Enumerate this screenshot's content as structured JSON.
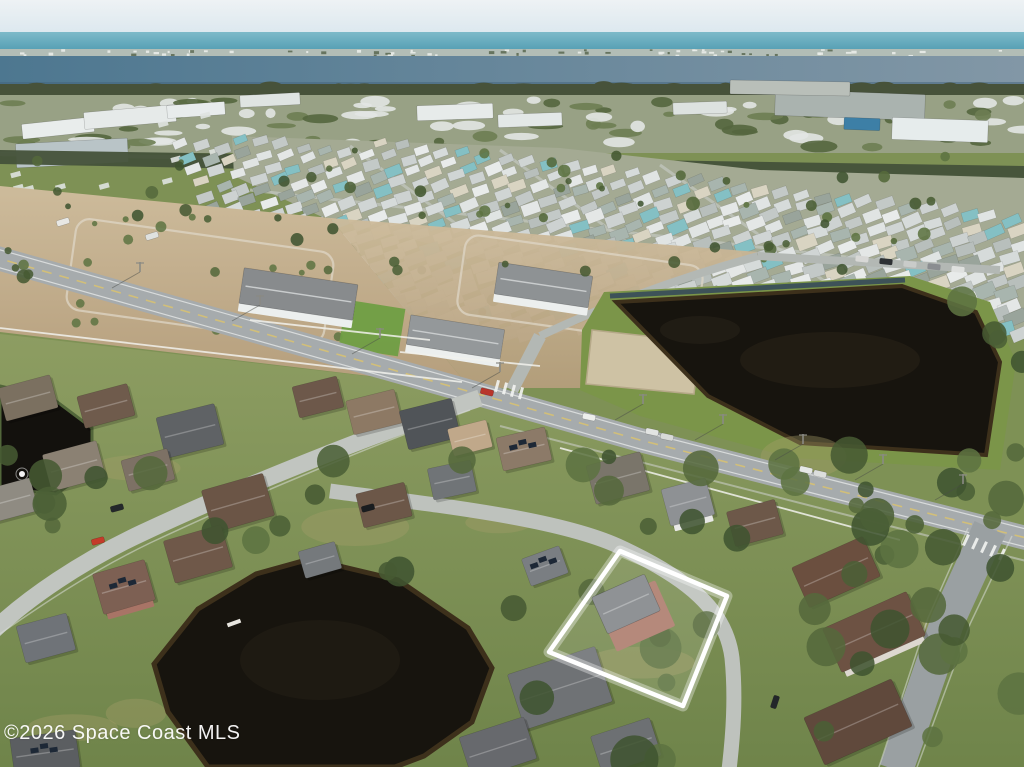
{
  "watermark": {
    "text": "©2026 Space Coast MLS"
  },
  "scene": {
    "seed": 1337,
    "bands": {
      "sky": {
        "y": 0,
        "h": 62,
        "from": "#eef2f4",
        "to": "#cde0ea"
      },
      "ocean": {
        "y": 32,
        "h": 25,
        "from": "#7dbac9",
        "to": "#4795ac"
      },
      "island": {
        "y": 49,
        "h": 9,
        "base": "#b2bdb6"
      },
      "lagoon": {
        "y": 56,
        "h": 32,
        "from": "#4d7790",
        "to": "#8297a6"
      },
      "treeline": {
        "y": 84,
        "h": 14,
        "color": "#47523a"
      },
      "suburb": {
        "y": 95,
        "h": 58,
        "base": "#98a185"
      },
      "darkband": {
        "points": "0,150 1024,166 1024,184 0,164",
        "color": "#45523a"
      }
    },
    "far_buildings": [
      [
        58,
        128,
        72,
        15,
        -6,
        "#e9edec"
      ],
      [
        130,
        117,
        92,
        17,
        -5,
        "#e6eae9"
      ],
      [
        196,
        110,
        58,
        13,
        -4,
        "#e8ecec"
      ],
      [
        72,
        153,
        112,
        24,
        -3,
        "#b9c4c7"
      ],
      [
        270,
        100,
        60,
        12,
        -3,
        "#dfe4e2"
      ],
      [
        455,
        112,
        76,
        15,
        -2,
        "#e7ebea"
      ],
      [
        530,
        120,
        64,
        13,
        -2,
        "#e3e8e7"
      ],
      [
        700,
        108,
        54,
        12,
        -2,
        "#dde2e0"
      ],
      [
        850,
        105,
        150,
        26,
        2,
        "#aab3af"
      ],
      [
        940,
        130,
        96,
        22,
        2,
        "#e6ecec"
      ],
      [
        862,
        124,
        36,
        12,
        2,
        "#3d7fa6"
      ],
      [
        790,
        88,
        120,
        14,
        1,
        "#b9bfb9"
      ]
    ],
    "suburb_road": {
      "d": "M 0 154 L 330 160",
      "w": 4,
      "color": "#b8bdb4"
    },
    "park": {
      "poly": [
        [
          232,
          136
        ],
        [
          560,
          148
        ],
        [
          760,
          170
        ],
        [
          1024,
          178
        ],
        [
          1024,
          336
        ],
        [
          902,
          288
        ],
        [
          614,
          302
        ],
        [
          470,
          254
        ],
        [
          320,
          216
        ],
        [
          234,
          176
        ]
      ],
      "base": "#a4aa93",
      "palette": [
        "#e8ebea",
        "#e0e4e3",
        "#d6dbda",
        "#cdd2d1",
        "#c3c9c7",
        "#b8bfbc",
        "#a8b5ae",
        "#84c0c4",
        "#d9d4c2",
        "#e4e7e6",
        "#d0d5d4",
        "#99a49b"
      ],
      "roads": [
        "M 350 146 L 560 300",
        "M 500 150 L 700 295",
        "M 660 165 L 830 285",
        "M 250 190 L 980 272"
      ]
    },
    "dirt": {
      "d1": [
        [
          0,
          186
        ],
        [
          330,
          218
        ],
        [
          470,
          388
        ],
        [
          0,
          332
        ]
      ],
      "d2": [
        [
          330,
          218
        ],
        [
          758,
          252
        ],
        [
          614,
          300
        ],
        [
          600,
          388
        ],
        [
          470,
          388
        ]
      ],
      "from": "#cdbb9b",
      "to": "#b59e7c",
      "loops": [
        [
          200,
          281,
          260,
          92,
          8
        ],
        [
          580,
          290,
          240,
          80,
          8
        ]
      ]
    },
    "dev_roads": [
      {
        "d": "M 512 390 L 540 336",
        "w": 13
      },
      {
        "d": "M 540 336 C 620 298 700 272 758 256",
        "w": 8
      },
      {
        "d": "M 758 256 L 1000 270",
        "w": 8
      }
    ],
    "townhomes": [
      [
        298,
        297,
        115,
        36,
        8.5,
        "#888b8d"
      ],
      [
        455,
        340,
        95,
        30,
        9,
        "#94989a"
      ],
      [
        543,
        288,
        95,
        32,
        8.5,
        "#8e9294"
      ]
    ],
    "sod": [
      372,
      328,
      60,
      48,
      9,
      "#6f9e43"
    ],
    "pond_bank": [
      [
        604,
        292
      ],
      [
        910,
        276
      ],
      [
        990,
        302
      ],
      [
        1016,
        362
      ],
      [
        1000,
        470
      ],
      [
        792,
        458
      ],
      [
        640,
        416
      ],
      [
        580,
        390
      ],
      [
        582,
        330
      ]
    ],
    "canal": {
      "d": "M 610 296 L 905 280",
      "color": "#33475a",
      "w": 5
    },
    "sand_patch": [
      [
        592,
        330
      ],
      [
        700,
        342
      ],
      [
        694,
        394
      ],
      [
        586,
        384
      ]
    ],
    "pond_main": [
      [
        616,
        302
      ],
      [
        902,
        286
      ],
      [
        976,
        312
      ],
      [
        1000,
        362
      ],
      [
        986,
        455
      ],
      [
        800,
        443
      ],
      [
        708,
        396
      ]
    ],
    "pond_left": [
      [
        0,
        386
      ],
      [
        52,
        398
      ],
      [
        92,
        428
      ],
      [
        92,
        470
      ],
      [
        56,
        494
      ],
      [
        0,
        488
      ]
    ],
    "pond_bottom": [
      [
        310,
        559
      ],
      [
        398,
        580
      ],
      [
        468,
        628
      ],
      [
        492,
        668
      ],
      [
        472,
        722
      ],
      [
        424,
        756
      ],
      [
        395,
        767
      ],
      [
        208,
        767
      ],
      [
        168,
        712
      ],
      [
        154,
        664
      ],
      [
        198,
        609
      ],
      [
        256,
        574
      ]
    ],
    "pond_colors": {
      "water": "#17140e",
      "rim": "#3d301b",
      "bank": "#7b9549"
    },
    "fountain": [
      22,
      474
    ],
    "dock": [
      234,
      623
    ],
    "fg": {
      "poly": [
        [
          0,
          334
        ],
        [
          470,
          388
        ],
        [
          640,
          436
        ],
        [
          820,
          482
        ],
        [
          1024,
          534
        ],
        [
          1024,
          767
        ],
        [
          0,
          767
        ]
      ],
      "from": "#8d9d62",
      "to": "#6f844a"
    },
    "arterial": {
      "d": "M -10 256 L 478 394 L 640 440 L 820 486 L 1034 540",
      "edge_n": "M -10 247 L 478 385 L 640 431 L 820 477 L 1034 531",
      "edge_s": "M -10 265 L 478 403 L 640 449 L 820 495 L 1034 549",
      "w": 24,
      "asphalt": "#a6abad",
      "center": "#d9c270",
      "sidewalk_s": "M 500 426 L 1030 562"
    },
    "streets": [
      {
        "name": "street-west",
        "d": "M 480 398 C 384 430 242 486 142 533 C 80 562 28 598 -6 630",
        "w": 17,
        "color": "#c1c5c0"
      },
      {
        "name": "street-curve",
        "d": "M 330 491 C 436 505 556 518 618 546 C 688 578 726 610 732 658 C 736 698 733 736 729 770",
        "w": 15,
        "color": "#bec2bd"
      },
      {
        "name": "street-east",
        "d": "M 990 528 L 948 620 L 896 770",
        "w": 34,
        "color": "#9aa0a2"
      }
    ],
    "street_sidewalks": [
      "M 470 410 C 380 442 250 496 150 543 C 90 572 40 606 -6 638",
      "M 968 528 L 928 618 L 878 770",
      "M 1012 536 L 970 624 L 916 770"
    ],
    "crosswalks": {
      "east": {
        "x": 966,
        "y": 540,
        "n": 5,
        "dx": 9,
        "dy": 3.6,
        "rot": 25
      },
      "entrance": {
        "x": 497,
        "y": 386,
        "n": 4,
        "dx": 8,
        "dy": 2.4,
        "rot": 15
      }
    },
    "fences": [
      "M 0 328 L 462 382",
      "M 560 448 L 900 540",
      "M 250 320 L 430 340",
      "M 400 352 L 540 366"
    ],
    "houses": [
      [
        28,
        398,
        54,
        34,
        -15,
        "#7b7060",
        null,
        0
      ],
      [
        106,
        406,
        52,
        33,
        -15,
        "#6f5b4c",
        null,
        0
      ],
      [
        190,
        431,
        60,
        42,
        -14,
        "#5f6265",
        null,
        0
      ],
      [
        318,
        397,
        46,
        32,
        -14,
        "#6d584a",
        null,
        0
      ],
      [
        374,
        412,
        50,
        35,
        -14,
        "#8d7964",
        null,
        0
      ],
      [
        430,
        424,
        54,
        40,
        -14,
        "#505458",
        null,
        0
      ],
      [
        470,
        438,
        40,
        28,
        -14,
        "#c0a88a",
        null,
        0
      ],
      [
        524,
        449,
        50,
        34,
        -13,
        "#8c7a68",
        null,
        1
      ],
      [
        618,
        478,
        56,
        40,
        -15,
        "#7a756a",
        null,
        0
      ],
      [
        688,
        502,
        46,
        38,
        -15,
        "#8e9194",
        "#e8e8e6",
        0
      ],
      [
        755,
        523,
        50,
        36,
        -15,
        "#6d5849",
        null,
        0
      ],
      [
        12,
        500,
        46,
        34,
        -15,
        "#8f8b82",
        null,
        0
      ],
      [
        74,
        466,
        56,
        38,
        -15,
        "#8b8173",
        null,
        0
      ],
      [
        148,
        470,
        48,
        32,
        -15,
        "#7d7165",
        null,
        0
      ],
      [
        238,
        503,
        64,
        44,
        -16,
        "#6b5546",
        null,
        0
      ],
      [
        198,
        554,
        60,
        44,
        -16,
        "#6f5849",
        null,
        0
      ],
      [
        124,
        587,
        54,
        42,
        -16,
        "#7d6053",
        "#a87466",
        1
      ],
      [
        46,
        638,
        52,
        38,
        -15,
        "#6f7378",
        null,
        0
      ],
      [
        384,
        505,
        50,
        35,
        -14,
        "#6c5748",
        null,
        0
      ],
      [
        452,
        480,
        44,
        32,
        -12,
        "#707477",
        null,
        0
      ],
      [
        545,
        566,
        40,
        29,
        -20,
        "#7a7e82",
        null,
        1
      ],
      [
        836,
        572,
        78,
        44,
        -24,
        "#6b4f3f",
        null,
        0
      ],
      [
        874,
        632,
        92,
        48,
        -24,
        "#6d5243",
        "#ddd8d0",
        0
      ],
      [
        858,
        722,
        96,
        52,
        -24,
        "#60493c",
        null,
        0
      ],
      [
        560,
        688,
        92,
        58,
        -18,
        "#6f7275",
        null,
        0
      ],
      [
        498,
        748,
        68,
        44,
        -18,
        "#67696d",
        null,
        0
      ],
      [
        626,
        746,
        62,
        40,
        -18,
        "#6d7073",
        null,
        0
      ],
      [
        45,
        753,
        66,
        38,
        -8,
        "#5b5e61",
        null,
        1
      ],
      [
        320,
        560,
        38,
        28,
        -16,
        "#75797c",
        null,
        0
      ]
    ],
    "highlight": {
      "outline": "620,551 727,596 683,706 549,652",
      "wall": [
        636,
        616,
        64,
        50,
        -24,
        "#b5897b"
      ],
      "roof": [
        626,
        604,
        58,
        40,
        -24,
        "#8f9295"
      ]
    },
    "cars": [
      [
        98,
        541,
        -15,
        "#c43b2a"
      ],
      [
        117,
        508,
        -15,
        "#24282b"
      ],
      [
        589,
        417,
        12,
        "#eceeec"
      ],
      [
        652,
        432,
        12,
        "#e2e4e2"
      ],
      [
        667,
        437,
        12,
        "#d8dad8"
      ],
      [
        487,
        392,
        14,
        "#b8352b"
      ],
      [
        775,
        702,
        -72,
        "#23262a"
      ],
      [
        63,
        222,
        -17,
        "#e8e8e4"
      ],
      [
        368,
        508,
        -15,
        "#1a1d20"
      ],
      [
        806,
        470,
        13,
        "#e6e8e6"
      ],
      [
        820,
        474,
        13,
        "#dcdedc"
      ],
      [
        152,
        236,
        -17,
        "#dfe1df"
      ]
    ],
    "parked_row": {
      "x": 862,
      "y": 259,
      "n": 5,
      "dx": 24,
      "dy": 2.6,
      "colors": [
        "#d8d8d6",
        "#2e3134",
        "#c9cbc9",
        "#8a8d90",
        "#dfe1df"
      ]
    },
    "poles": [
      [
        643,
        404
      ],
      [
        723,
        424
      ],
      [
        803,
        444
      ],
      [
        883,
        464
      ],
      [
        963,
        484
      ],
      [
        500,
        372
      ],
      [
        380,
        338
      ],
      [
        260,
        305
      ],
      [
        140,
        272
      ]
    ],
    "tree_palette": [
      "#4b5f36",
      "#55693c",
      "#3f5430",
      "#5d7342",
      "#465a33"
    ],
    "tree_regions": [
      {
        "x": 0,
        "y": 352,
        "w": 1024,
        "h": 108,
        "n": 36,
        "small": 0
      },
      {
        "x": 0,
        "y": 460,
        "w": 500,
        "h": 305,
        "n": 42,
        "small": 0
      },
      {
        "x": 500,
        "y": 460,
        "w": 524,
        "h": 305,
        "n": 40,
        "small": 0
      },
      {
        "x": 240,
        "y": 150,
        "w": 720,
        "h": 140,
        "n": 30,
        "small": 1
      },
      {
        "x": 935,
        "y": 300,
        "w": 89,
        "h": 195,
        "n": 14,
        "small": 0
      },
      {
        "x": 0,
        "y": 150,
        "w": 230,
        "h": 140,
        "n": 16,
        "small": 1
      }
    ],
    "mud_patches": 8
  }
}
